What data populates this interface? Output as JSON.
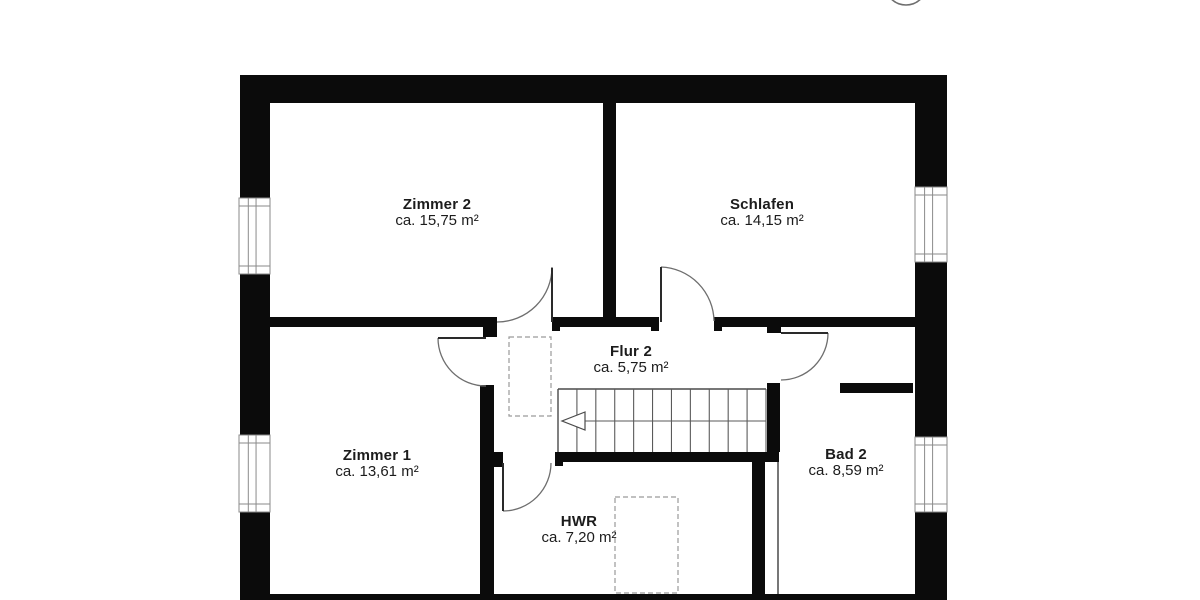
{
  "meta": {
    "drawing_type": "floor plan (upper storey)",
    "language": "de"
  },
  "colors": {
    "wall": "#0b0b0b",
    "leaf": "#2a2a2a",
    "door_arc": "#6e6e6e",
    "thin_line": "#4a4a4a",
    "stair_line": "#5a5a5a",
    "window_frame": "#8a8a8a",
    "dashed": "#9a9a9a",
    "background": "#ffffff",
    "text": "#1c1c1c"
  },
  "rooms": [
    {
      "id": "zimmer2",
      "name": "Zimmer 2",
      "area": "ca. 15,75 m²",
      "label_x": 437,
      "label_y": 197
    },
    {
      "id": "schlafen",
      "name": "Schlafen",
      "area": "ca. 14,15 m²",
      "label_x": 762,
      "label_y": 197
    },
    {
      "id": "flur2",
      "name": "Flur 2",
      "area": "ca. 5,75 m²",
      "label_x": 631,
      "label_y": 344
    },
    {
      "id": "zimmer1",
      "name": "Zimmer 1",
      "area": "ca. 13,61 m²",
      "label_x": 377,
      "label_y": 448
    },
    {
      "id": "bad2",
      "name": "Bad 2",
      "area": "ca. 8,59 m²",
      "label_x": 846,
      "label_y": 447
    },
    {
      "id": "hwr",
      "name": "HWR",
      "area": "ca. 7,20 m²",
      "label_x": 579,
      "label_y": 514
    }
  ],
  "plan": {
    "canvas": {
      "w": 1200,
      "h": 600
    },
    "walls": [
      {
        "n": "exterior-wall-top",
        "r": [
          240,
          75,
          707,
          28
        ]
      },
      {
        "n": "exterior-wall-left-upper",
        "r": [
          240,
          75,
          30,
          123
        ]
      },
      {
        "n": "exterior-wall-left-middle",
        "r": [
          240,
          274,
          30,
          161
        ]
      },
      {
        "n": "exterior-wall-left-lower",
        "r": [
          240,
          512,
          30,
          88
        ]
      },
      {
        "n": "exterior-wall-right-upper",
        "r": [
          915,
          75,
          32,
          112
        ]
      },
      {
        "n": "exterior-wall-right-middle",
        "r": [
          915,
          262,
          32,
          175
        ]
      },
      {
        "n": "exterior-wall-right-lower",
        "r": [
          915,
          512,
          32,
          88
        ]
      },
      {
        "n": "exterior-wall-bottom",
        "r": [
          240,
          594,
          707,
          6
        ]
      },
      {
        "n": "wall-corridor-left",
        "r": [
          270,
          317,
          227,
          10
        ]
      },
      {
        "n": "wall-corridor-middle",
        "r": [
          552,
          317,
          107,
          10
        ]
      },
      {
        "n": "wall-corridor-right",
        "r": [
          714,
          317,
          201,
          10
        ]
      },
      {
        "n": "wall-zimmer2-schlafen",
        "r": [
          603,
          103,
          13,
          214
        ]
      },
      {
        "n": "wall-zimmer1-stub",
        "r": [
          483,
          327,
          14,
          10
        ]
      },
      {
        "n": "wall-zimmer1-right",
        "r": [
          480,
          385,
          14,
          215
        ]
      },
      {
        "n": "wall-under-stairs-left",
        "r": [
          480,
          452,
          23,
          10
        ]
      },
      {
        "n": "wall-under-stairs",
        "r": [
          555,
          452,
          224,
          10
        ]
      },
      {
        "n": "wall-flur-bad2",
        "r": [
          767,
          383,
          13,
          69
        ]
      },
      {
        "n": "wall-hwr-right",
        "r": [
          752,
          462,
          13,
          138
        ]
      },
      {
        "n": "wall-bad2-stub",
        "r": [
          840,
          383,
          73,
          10
        ]
      },
      {
        "n": "door-jamb-bad2",
        "r": [
          767,
          317,
          14,
          16
        ]
      },
      {
        "n": "door-jamb-zimmer2-left",
        "r": [
          489,
          317,
          8,
          14
        ]
      },
      {
        "n": "door-jamb-zimmer2-right",
        "r": [
          552,
          317,
          8,
          14
        ]
      },
      {
        "n": "door-jamb-schlafen-left",
        "r": [
          651,
          317,
          8,
          14
        ]
      },
      {
        "n": "door-jamb-schlafen-right",
        "r": [
          714,
          317,
          8,
          14
        ]
      },
      {
        "n": "door-jamb-hwr-left",
        "r": [
          490,
          452,
          13,
          15
        ]
      },
      {
        "n": "door-jamb-hwr-right",
        "r": [
          555,
          452,
          8,
          14
        ]
      }
    ],
    "windows": [
      {
        "n": "window-zimmer2-left",
        "r": [
          239,
          198,
          31,
          76
        ]
      },
      {
        "n": "window-zimmer1-left",
        "r": [
          239,
          435,
          31,
          77
        ]
      },
      {
        "n": "window-schlafen-right",
        "r": [
          915,
          187,
          32,
          75
        ]
      },
      {
        "n": "window-bad2-right",
        "r": [
          915,
          437,
          32,
          75
        ]
      }
    ],
    "doors": [
      {
        "n": "door-zimmer2",
        "leaf": [
          552,
          268,
          552,
          322
        ],
        "arc": "M 497 322 A 55 55 0 0 0 552 267"
      },
      {
        "n": "door-schlafen",
        "leaf": [
          661,
          267,
          661,
          322
        ],
        "arc": "M 661 267 A 55 55 0 0 1 714 321"
      },
      {
        "n": "door-zimmer1",
        "leaf": [
          438,
          338,
          486,
          338
        ],
        "arc": "M 438 338 A 48 48 0 0 0 486 386"
      },
      {
        "n": "door-bad2",
        "leaf": [
          781,
          333,
          828,
          333
        ],
        "arc": "M 828 333 A 47 47 0 0 1 781 380"
      },
      {
        "n": "door-hwr",
        "leaf": [
          503,
          463,
          503,
          511
        ],
        "arc": "M 503 511 A 48 48 0 0 0 551 463"
      }
    ],
    "dashed_rects": [
      {
        "n": "shaft-flur2-dashed",
        "r": [
          509,
          337,
          42,
          79
        ]
      },
      {
        "n": "shaft-hwr-dashed",
        "r": [
          615,
          497,
          63,
          96
        ]
      }
    ],
    "stairs": {
      "x0": 558,
      "y0": 389,
      "x1": 766,
      "y1": 452,
      "tread_lines": 12,
      "walk_line_y": 421,
      "arrow": [
        [
          585,
          412
        ],
        [
          562,
          421
        ],
        [
          585,
          430
        ]
      ]
    },
    "thin_lines": [
      {
        "n": "wall-face-line-bad2-left",
        "l": [
          778,
          462,
          778,
          594
        ]
      }
    ],
    "top_circle": {
      "cx": 906,
      "cy": -16,
      "r": 21
    }
  }
}
